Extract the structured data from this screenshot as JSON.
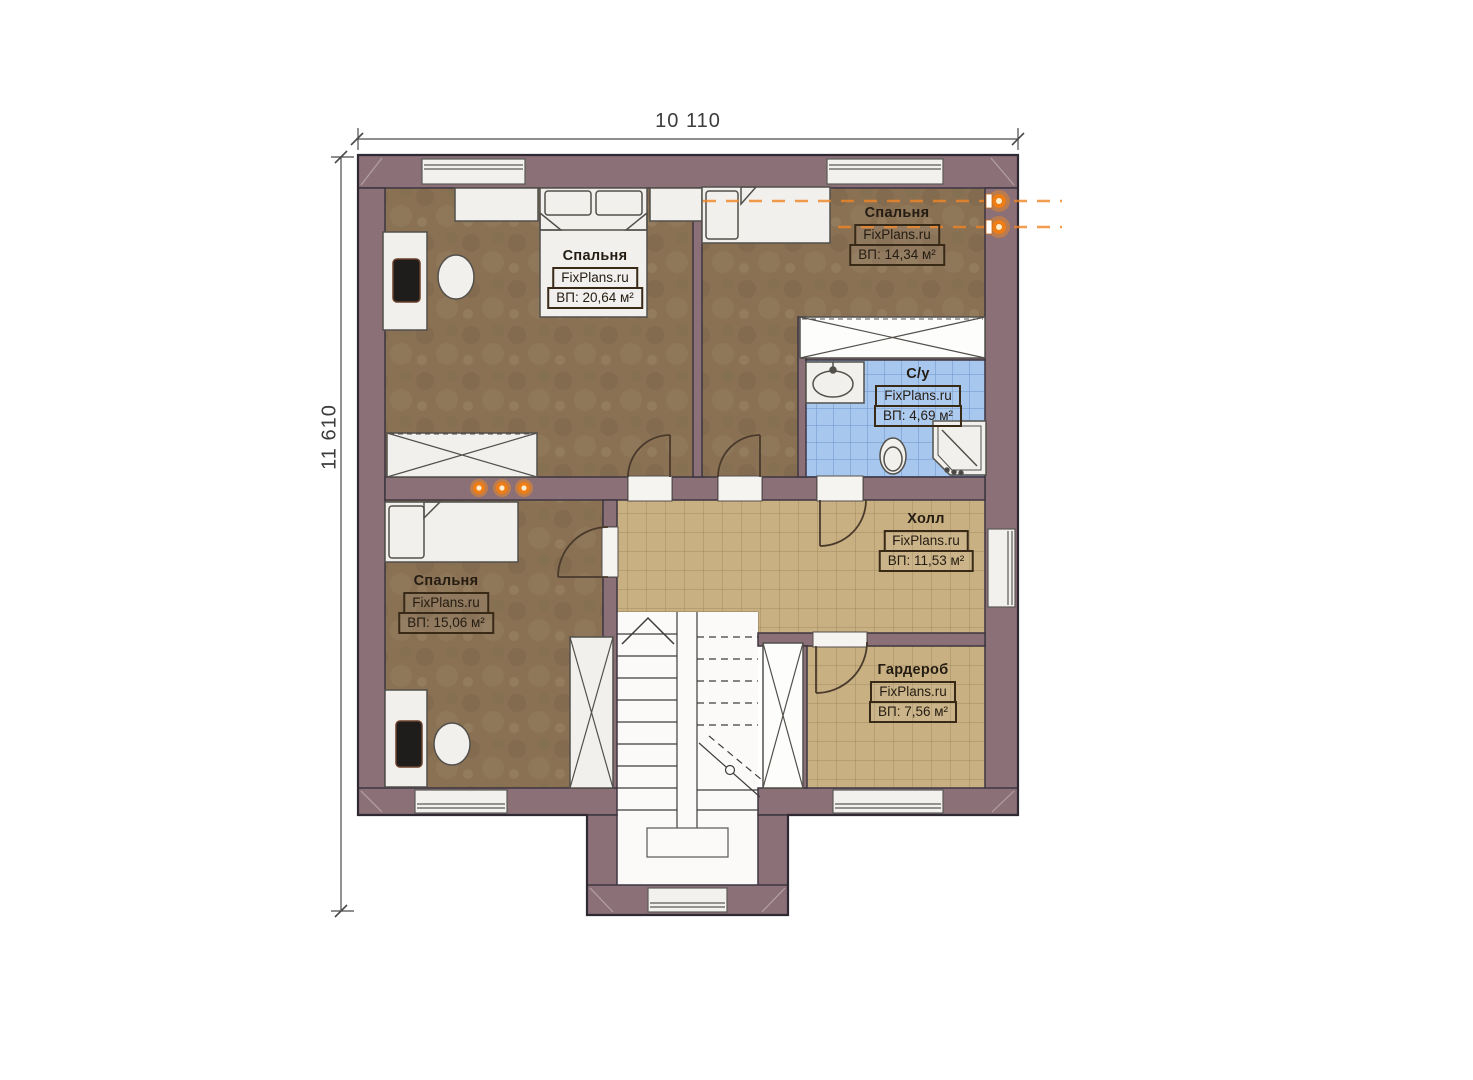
{
  "dimensions": {
    "top": "10 110",
    "left": "11 610"
  },
  "brand": "FixPlans.ru",
  "rooms": [
    {
      "key": "bedroom-top-left",
      "name": "Спальня",
      "brand": "FixPlans.ru",
      "area": "ВП: 20,64 м²"
    },
    {
      "key": "bedroom-top-right",
      "name": "Спальня",
      "brand": "FixPlans.ru",
      "area": "ВП: 14,34 м²"
    },
    {
      "key": "bathroom",
      "name": "С/у",
      "brand": "FixPlans.ru",
      "area": "ВП: 4,69 м²"
    },
    {
      "key": "hall",
      "name": "Холл",
      "brand": "FixPlans.ru",
      "area": "ВП: 11,53 м²"
    },
    {
      "key": "bedroom-bottom-left",
      "name": "Спальня",
      "brand": "FixPlans.ru",
      "area": "ВП: 15,06 м²"
    },
    {
      "key": "wardrobe",
      "name": "Гардероб",
      "brand": "FixPlans.ru",
      "area": "ВП: 7,56 м²"
    }
  ],
  "colors": {
    "wall": "#8b7077",
    "outline": "#38323d",
    "bedroom_floor": "#8a7154",
    "tile_floor": "#c8b082",
    "bath_tile": "#a8c7ee",
    "accent_light": "#ef8425",
    "furniture": "#f2f0ed"
  }
}
